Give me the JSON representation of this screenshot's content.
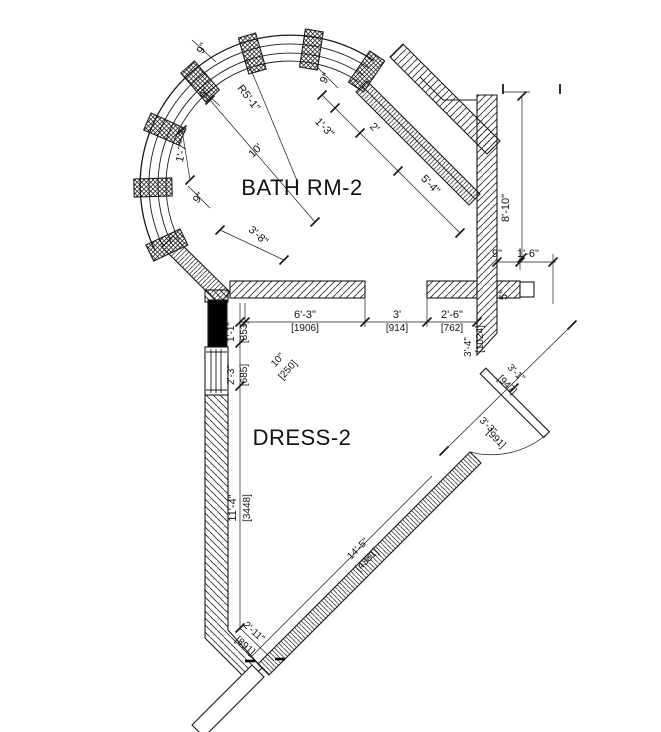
{
  "rooms": {
    "bath_label": "BATH RM-2",
    "dress_label": "DRESS-2"
  },
  "dims": {
    "bay_9_a": "9\"",
    "bay_9_b": "9\"",
    "bay_9_c": "9\"",
    "bay_radius": "R5'-1\"",
    "bay_10": "10'",
    "bay_1_7": "1'-7\"",
    "ne_9": "9\"",
    "ne_1_3": "1'-3\"",
    "ne_2": "2'",
    "ne_5_4": "5'-4\"",
    "sw_3_8": "3'-8\"",
    "right_8_10": "8'-10\"",
    "right_9": "9\"",
    "right_1_6": "1'-6\"",
    "right_5": "5\"",
    "right_3_4": "3'-4\"",
    "right_3_4_mm": "[1024]",
    "h_6_3": "6'-3\"",
    "h_6_3_mm": "[1906]",
    "h_3": "3'",
    "h_3_mm": "[914]",
    "h_2_6": "2'-6\"",
    "h_2_6_mm": "[762]",
    "v_1_1": "1'-1\"",
    "v_1_1_mm": "[353]",
    "v_2_3": "2'-3\"",
    "v_2_3_mm": "[685]",
    "diag_10": "10\"",
    "diag_10_mm": "[250]",
    "v_11_4": "11'-4\"",
    "v_11_4_mm": "[3448]",
    "se_14_5": "14'-5\"",
    "se_14_5_mm": "[4381]",
    "sw_2_11": "2'-11\"",
    "sw_2_11_mm": "[891]",
    "door_3_1": "3'-1\"",
    "door_3_1_mm": "[947]",
    "door_3_3": "3'-3\"",
    "door_3_3_mm": "[991]"
  },
  "colors": {
    "line": "#1a1a1a",
    "solid_fill": "#000000",
    "background": "#ffffff"
  }
}
